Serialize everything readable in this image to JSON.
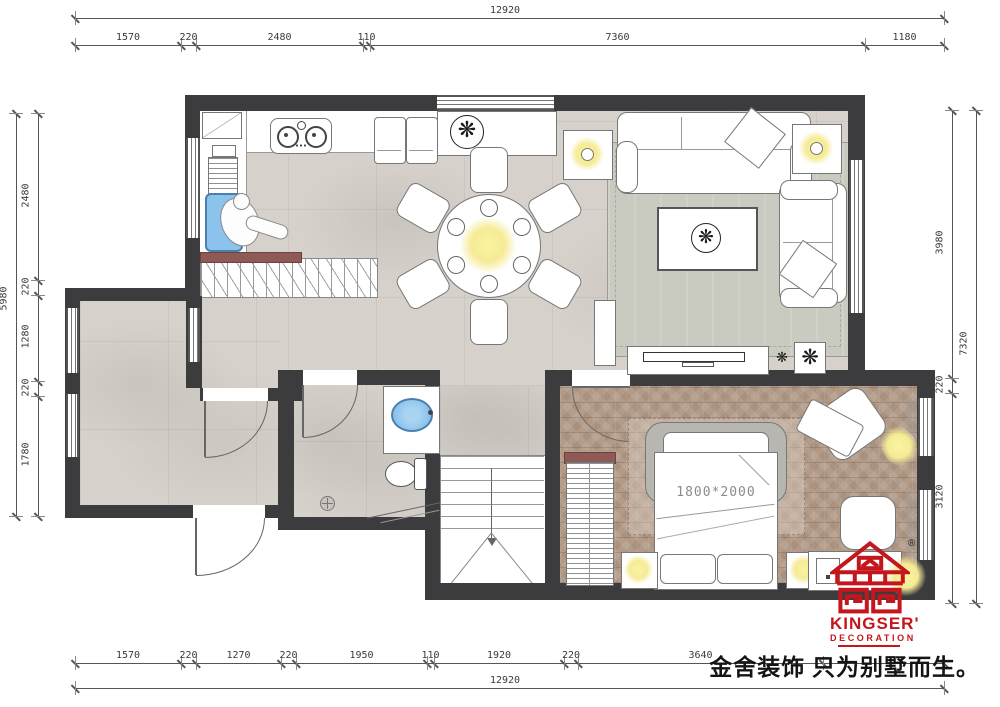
{
  "meta": {
    "type": "residential floor plan drawing",
    "tagline": "金舍装饰 只为别墅而生。"
  },
  "logo": {
    "name": "KINGSER'",
    "sub": "DECORATION",
    "reg": "®"
  },
  "labels": {
    "bed_size": "1800*2000"
  },
  "dimensions": {
    "top": {
      "total": "12920",
      "segments": [
        "1570",
        "220",
        "2480",
        "110",
        "7360",
        "1180"
      ]
    },
    "bottom": {
      "total": "12920",
      "segments": [
        "1570",
        "220",
        "1270",
        "220",
        "1950",
        "110",
        "1920",
        "220",
        "3640"
      ]
    },
    "left": {
      "total": "5980",
      "segments": [
        "2480",
        "220",
        "1280",
        "220",
        "1780"
      ]
    },
    "right": {
      "total": "7320",
      "segments": [
        "3980",
        "220",
        "3120"
      ]
    }
  },
  "icons": {
    "plant_glyph": "❋"
  },
  "colors": {
    "wall": "#3c3c3e",
    "floor_gray": "#d6d2cb",
    "floor_wood": "#b29a87",
    "lamp_yellow": "#f5eb96",
    "sink_blue": "#8cc3ec",
    "stair_stringer": "#8f5a55",
    "brand_red": "#c4161c"
  }
}
